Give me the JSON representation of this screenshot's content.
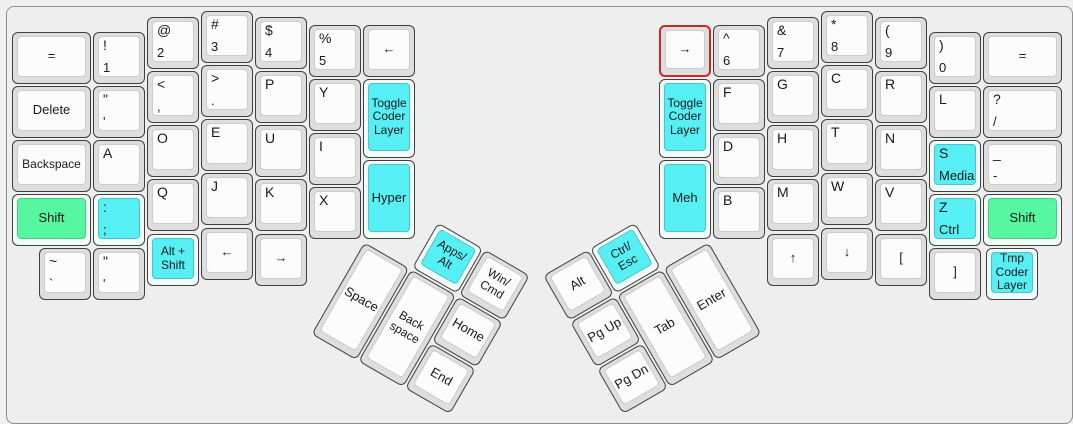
{
  "app": {
    "name": "keyboard-layout-editor",
    "layout_name": "ergodox-coder-layout"
  },
  "colors": {
    "background": "#f0f0f0",
    "canvas": "#eeeeee",
    "frame_border": "#8f8f8f",
    "key_rim": "#dedede",
    "key_border": "#3f3f3f",
    "key_face": "#fcfcfc",
    "cyan_face": "#55eff4",
    "cyan_rim": "#f0fbfb",
    "green_face": "#57f6a1",
    "green_rim": "#f0fcf6",
    "selected_border": "#cb2727",
    "label_color": "#1a1a1a"
  },
  "unit": 54,
  "left_main": [
    {
      "name": "equals-left",
      "x": 11,
      "y": 31,
      "w": 81,
      "center": "="
    },
    {
      "name": "1",
      "x": 92,
      "y": 31,
      "top": "!",
      "bottom": "1"
    },
    {
      "name": "2",
      "x": 146,
      "y": 16,
      "top": "@",
      "bottom": "2"
    },
    {
      "name": "3",
      "x": 200,
      "y": 10,
      "top": "#",
      "bottom": "3"
    },
    {
      "name": "4",
      "x": 254,
      "y": 16,
      "top": "$",
      "bottom": "4"
    },
    {
      "name": "5",
      "x": 308,
      "y": 24,
      "top": "%",
      "bottom": "5"
    },
    {
      "name": "arrow-left-top",
      "x": 362,
      "y": 24,
      "center": "←"
    },
    {
      "name": "delete",
      "x": 11,
      "y": 85,
      "w": 81,
      "center": "Delete"
    },
    {
      "name": "quote",
      "x": 92,
      "y": 85,
      "top": "\"",
      "bottom": "'"
    },
    {
      "name": "comma",
      "x": 146,
      "y": 70,
      "top": "<",
      "bottom": ","
    },
    {
      "name": "period",
      "x": 200,
      "y": 64,
      "top": ">",
      "bottom": "."
    },
    {
      "name": "p",
      "x": 254,
      "y": 70,
      "top": "P"
    },
    {
      "name": "y",
      "x": 308,
      "y": 78,
      "top": "Y"
    },
    {
      "name": "toggle-coder-layer-left",
      "x": 362,
      "y": 78,
      "h": 81,
      "color": "cyan",
      "center": "Toggle\nCoder\nLayer"
    },
    {
      "name": "backspace-left",
      "x": 11,
      "y": 139,
      "w": 81,
      "center": "Backspace"
    },
    {
      "name": "a",
      "x": 92,
      "y": 139,
      "top": "A"
    },
    {
      "name": "o",
      "x": 146,
      "y": 124,
      "top": "O"
    },
    {
      "name": "e",
      "x": 200,
      "y": 118,
      "top": "E"
    },
    {
      "name": "u",
      "x": 254,
      "y": 124,
      "top": "U"
    },
    {
      "name": "i",
      "x": 308,
      "y": 132,
      "top": "I"
    },
    {
      "name": "shift-left",
      "x": 11,
      "y": 193,
      "w": 81,
      "color": "green",
      "center": "Shift"
    },
    {
      "name": "semicolon",
      "x": 92,
      "y": 193,
      "color": "cyan",
      "top": ":",
      "bottom": ";"
    },
    {
      "name": "q",
      "x": 146,
      "y": 178,
      "top": "Q"
    },
    {
      "name": "j",
      "x": 200,
      "y": 172,
      "top": "J"
    },
    {
      "name": "k",
      "x": 254,
      "y": 178,
      "top": "K"
    },
    {
      "name": "x",
      "x": 308,
      "y": 186,
      "top": "X"
    },
    {
      "name": "hyper",
      "x": 362,
      "y": 159,
      "h": 81,
      "color": "cyan",
      "center": "Hyper"
    },
    {
      "name": "grave",
      "x": 38,
      "y": 247,
      "top": "~",
      "bottom": "`"
    },
    {
      "name": "quote-2",
      "x": 92,
      "y": 247,
      "top": "\"",
      "bottom": "'"
    },
    {
      "name": "alt-shift",
      "x": 146,
      "y": 233,
      "color": "cyan",
      "center": "Alt +\nShift"
    },
    {
      "name": "arrow-left-bottom",
      "x": 200,
      "y": 227,
      "center": "←"
    },
    {
      "name": "arrow-right-bottom",
      "x": 254,
      "y": 233,
      "center": "→"
    }
  ],
  "right_main": [
    {
      "name": "arrow-right-selected",
      "x": 658,
      "y": 24,
      "selected": true,
      "center": "→"
    },
    {
      "name": "6",
      "x": 712,
      "y": 24,
      "top": "^",
      "bottom": "6"
    },
    {
      "name": "7",
      "x": 766,
      "y": 16,
      "top": "&",
      "bottom": "7"
    },
    {
      "name": "8",
      "x": 820,
      "y": 10,
      "top": "*",
      "bottom": "8"
    },
    {
      "name": "9",
      "x": 874,
      "y": 16,
      "top": "(",
      "bottom": "9"
    },
    {
      "name": "0",
      "x": 928,
      "y": 31,
      "top": ")",
      "bottom": "0"
    },
    {
      "name": "equals-right",
      "x": 982,
      "y": 31,
      "w": 81,
      "center": "="
    },
    {
      "name": "toggle-coder-layer-right",
      "x": 658,
      "y": 78,
      "h": 81,
      "color": "cyan",
      "center": "Toggle\nCoder\nLayer"
    },
    {
      "name": "f",
      "x": 712,
      "y": 78,
      "top": "F"
    },
    {
      "name": "g",
      "x": 766,
      "y": 70,
      "top": "G"
    },
    {
      "name": "c",
      "x": 820,
      "y": 64,
      "top": "C"
    },
    {
      "name": "r",
      "x": 874,
      "y": 70,
      "top": "R"
    },
    {
      "name": "l",
      "x": 928,
      "y": 85,
      "top": "L"
    },
    {
      "name": "slash",
      "x": 982,
      "y": 85,
      "w": 81,
      "top": "?",
      "bottom": "/"
    },
    {
      "name": "d",
      "x": 712,
      "y": 132,
      "top": "D"
    },
    {
      "name": "h",
      "x": 766,
      "y": 124,
      "top": "H"
    },
    {
      "name": "t",
      "x": 820,
      "y": 118,
      "top": "T"
    },
    {
      "name": "n",
      "x": 874,
      "y": 124,
      "top": "N"
    },
    {
      "name": "s-media",
      "x": 928,
      "y": 139,
      "color": "cyan",
      "top": "S",
      "bottom": "Media"
    },
    {
      "name": "minus",
      "x": 982,
      "y": 139,
      "w": 81,
      "top": "_",
      "bottom": "-"
    },
    {
      "name": "meh",
      "x": 658,
      "y": 159,
      "h": 81,
      "color": "cyan",
      "center": "Meh"
    },
    {
      "name": "b",
      "x": 712,
      "y": 186,
      "top": "B"
    },
    {
      "name": "m",
      "x": 766,
      "y": 178,
      "top": "M"
    },
    {
      "name": "w",
      "x": 820,
      "y": 172,
      "top": "W"
    },
    {
      "name": "v",
      "x": 874,
      "y": 178,
      "top": "V"
    },
    {
      "name": "z-ctrl",
      "x": 928,
      "y": 193,
      "color": "cyan",
      "top": "Z",
      "bottom": "Ctrl"
    },
    {
      "name": "shift-right",
      "x": 982,
      "y": 193,
      "w": 81,
      "color": "green",
      "center": "Shift"
    },
    {
      "name": "arrow-up",
      "x": 766,
      "y": 233,
      "center": "↑"
    },
    {
      "name": "arrow-down",
      "x": 820,
      "y": 227,
      "center": "↓"
    },
    {
      "name": "left-bracket",
      "x": 874,
      "y": 233,
      "center": "["
    },
    {
      "name": "right-bracket",
      "x": 928,
      "y": 247,
      "center": "]"
    },
    {
      "name": "tmp-coder-layer",
      "x": 985,
      "y": 247,
      "color": "cyan",
      "center": "Tmp\nCoder\nLayer"
    }
  ],
  "left_thumb": {
    "rotation": 30,
    "cx": 364,
    "cy": 241,
    "keys": [
      {
        "name": "apps-alt",
        "x": 54,
        "y": -54,
        "color": "cyan",
        "center": "Apps/\nAlt"
      },
      {
        "name": "win-cmd",
        "x": 108,
        "y": -54,
        "center": "Win/\nCmd"
      },
      {
        "name": "space",
        "x": 0,
        "y": 0,
        "h": 108,
        "center": "Space"
      },
      {
        "name": "thumb-backspace",
        "x": 54,
        "y": 0,
        "h": 108,
        "center": "Back\nspace"
      },
      {
        "name": "home",
        "x": 108,
        "y": 0,
        "center": "Home"
      },
      {
        "name": "end",
        "x": 108,
        "y": 54,
        "center": "End"
      }
    ]
  },
  "right_thumb": {
    "rotation": -30,
    "cx": 709,
    "cy": 241,
    "keys": [
      {
        "name": "alt",
        "x": -162,
        "y": -54,
        "center": "Alt"
      },
      {
        "name": "ctrl-esc",
        "x": -108,
        "y": -54,
        "color": "cyan",
        "center": "Ctrl/\nEsc"
      },
      {
        "name": "pg-up",
        "x": -162,
        "y": 0,
        "center": "Pg Up"
      },
      {
        "name": "tab",
        "x": -108,
        "y": 0,
        "h": 108,
        "center": "Tab"
      },
      {
        "name": "enter",
        "x": -54,
        "y": 0,
        "h": 108,
        "center": "Enter"
      },
      {
        "name": "pg-dn",
        "x": -162,
        "y": 54,
        "center": "Pg Dn"
      }
    ]
  }
}
